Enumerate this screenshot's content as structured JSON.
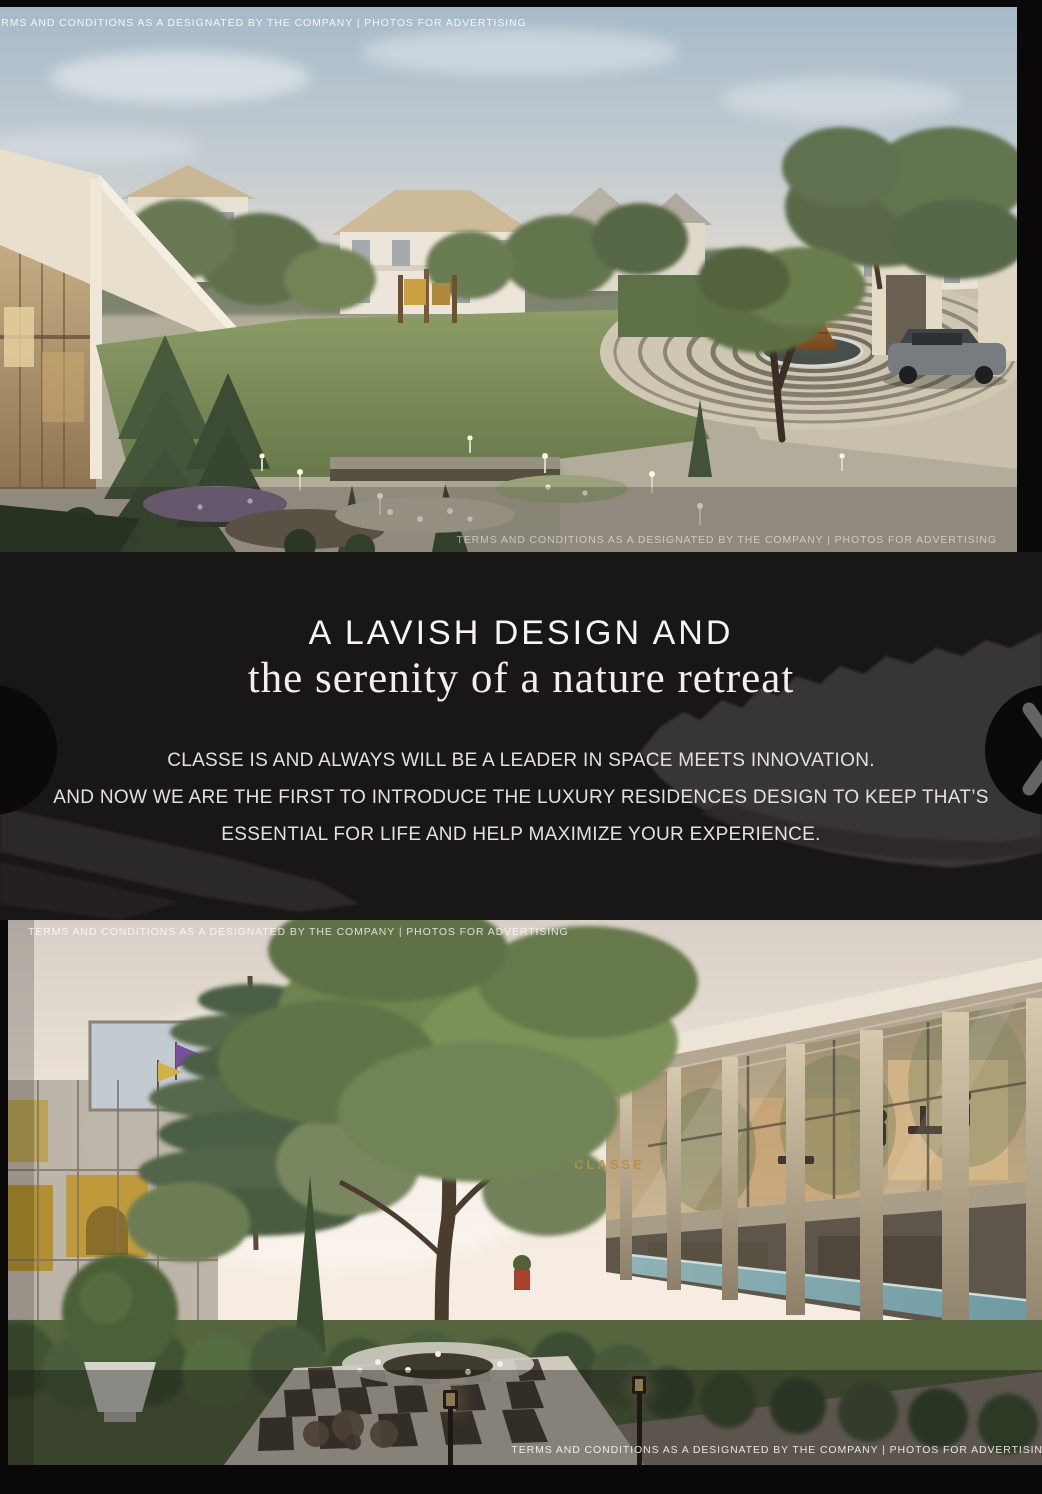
{
  "disclaimer": {
    "text": "TERMS AND CONDITIONS AS A DESIGNATED BY THE COMPANY | PHOTOS FOR ADVERTISING"
  },
  "intro": {
    "heading_caps": "A LAVISH DESIGN AND",
    "heading_serif": "the serenity of a nature retreat",
    "body_line1": "CLASSE IS AND ALWAYS WILL BE A LEADER IN SPACE MEETS INNOVATION.",
    "body_line2": "AND NOW WE ARE THE FIRST TO INTRODUCE THE LUXURY RESIDENCES DESIGN TO KEEP THAT’S",
    "body_line3": "ESSENTIAL FOR LIFE AND HELP MAXIMIZE YOUR EXPERIENCE."
  },
  "carousel": {
    "prev_icon": "chevron-left-icon",
    "next_icon": "chevron-right-icon"
  },
  "hero_bottom": {
    "signage": "CLASSE"
  },
  "colors": {
    "section_background": "#191617",
    "page_background": "#0a0809",
    "heading_text": "#f7f5f2",
    "body_text": "#e3e1df",
    "signage_gold": "#b69246"
  }
}
